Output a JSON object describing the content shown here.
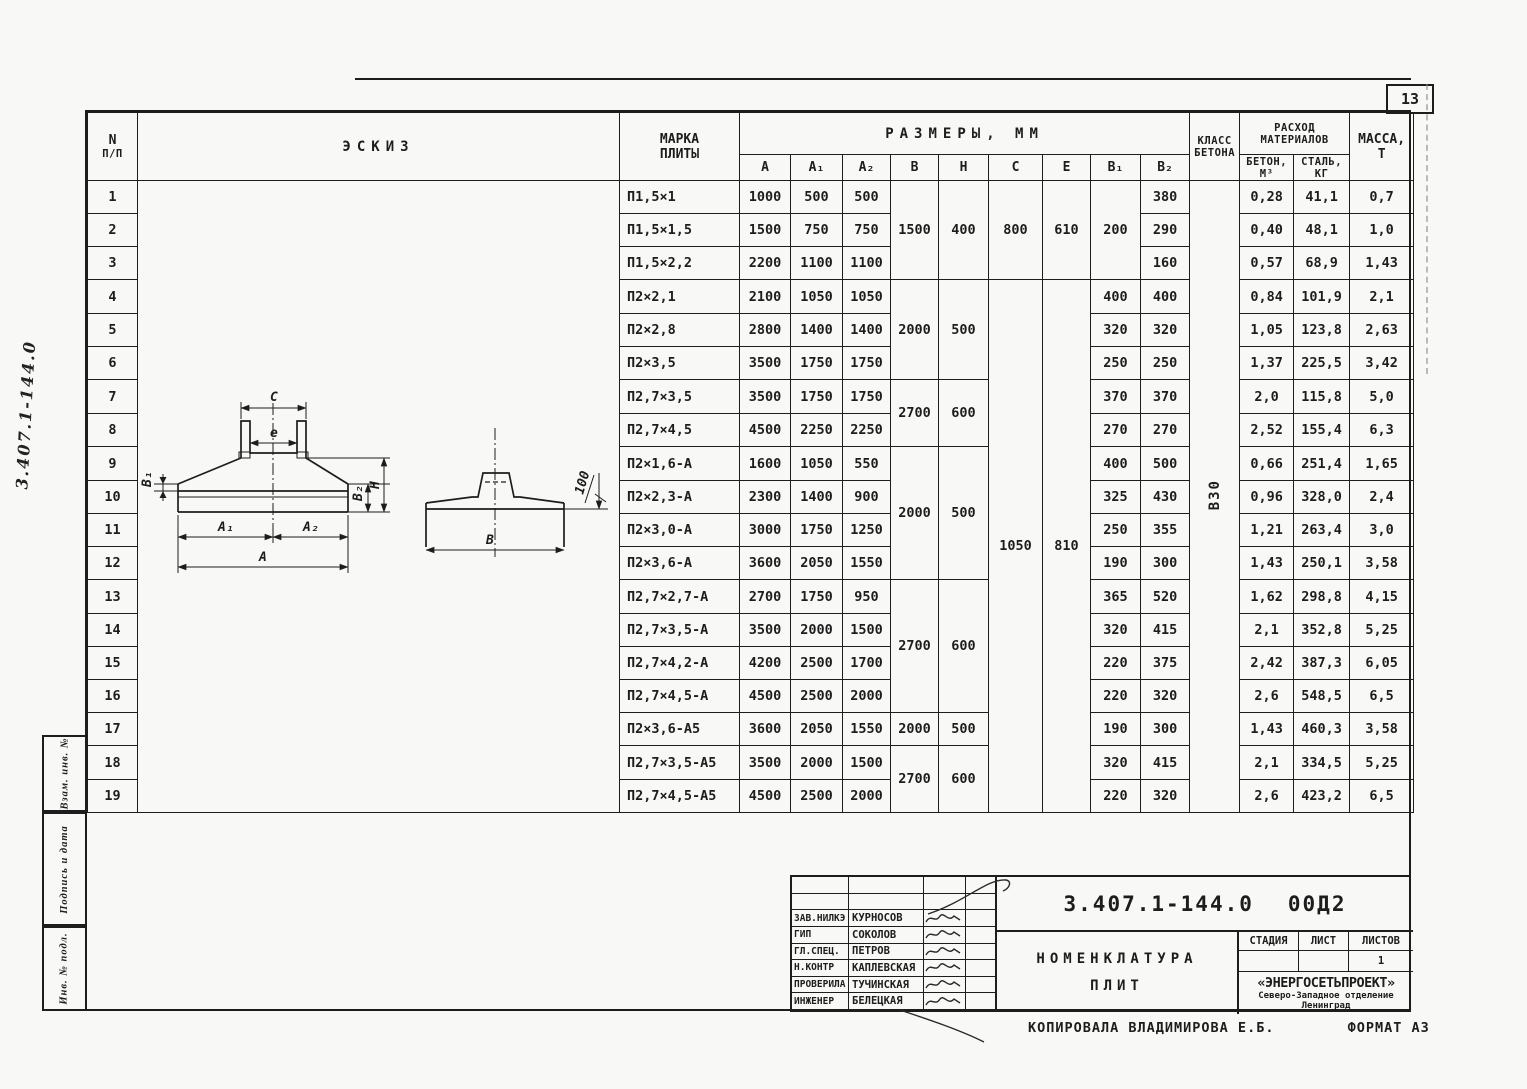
{
  "page": {
    "sheet_number": "13",
    "side_doc_number": "3.407.1-144.0",
    "bottom_note": "Копировала Владимирова Е.Б.",
    "bottom_format": "Формат А3"
  },
  "side_strip": {
    "cell1": "Взам. инв. №",
    "cell2": "Подпись и дата",
    "cell3": "Инв. № подл."
  },
  "table": {
    "header": {
      "num_l1": "N",
      "num_l2": "п/п",
      "sketch": "Эскиз",
      "mark_l1": "Марка",
      "mark_l2": "плиты",
      "sizes": "Размеры, мм",
      "size_cols": [
        "А",
        "А₁",
        "А₂",
        "В",
        "Н",
        "С",
        "е",
        "В₁",
        "В₂"
      ],
      "class_l1": "Класс",
      "class_l2": "бетона",
      "materials_l1": "Расход",
      "materials_l2": "материалов",
      "concrete_l1": "Бетон,",
      "concrete_l2": "м³",
      "steel_l1": "Сталь,",
      "steel_l2": "кг",
      "mass_l1": "Масса,",
      "mass_l2": "т"
    },
    "concrete_class": "В30",
    "rows": [
      {
        "n": "1",
        "mark": "П1,5×1",
        "a": "1000",
        "a1": "500",
        "a2": "500",
        "b2": "380",
        "concrete": "0,28",
        "steel": "41,1",
        "mass": "0,7"
      },
      {
        "n": "2",
        "mark": "П1,5×1,5",
        "a": "1500",
        "a1": "750",
        "a2": "750",
        "b2": "290",
        "concrete": "0,40",
        "steel": "48,1",
        "mass": "1,0"
      },
      {
        "n": "3",
        "mark": "П1,5×2,2",
        "a": "2200",
        "a1": "1100",
        "a2": "1100",
        "b2": "160",
        "concrete": "0,57",
        "steel": "68,9",
        "mass": "1,43"
      },
      {
        "n": "4",
        "mark": "П2×2,1",
        "a": "2100",
        "a1": "1050",
        "a2": "1050",
        "b2": "400",
        "concrete": "0,84",
        "steel": "101,9",
        "mass": "2,1"
      },
      {
        "n": "5",
        "mark": "П2×2,8",
        "a": "2800",
        "a1": "1400",
        "a2": "1400",
        "b2": "320",
        "concrete": "1,05",
        "steel": "123,8",
        "mass": "2,63"
      },
      {
        "n": "6",
        "mark": "П2×3,5",
        "a": "3500",
        "a1": "1750",
        "a2": "1750",
        "b2": "250",
        "concrete": "1,37",
        "steel": "225,5",
        "mass": "3,42"
      },
      {
        "n": "7",
        "mark": "П2,7×3,5",
        "a": "3500",
        "a1": "1750",
        "a2": "1750",
        "b2": "370",
        "concrete": "2,0",
        "steel": "115,8",
        "mass": "5,0"
      },
      {
        "n": "8",
        "mark": "П2,7×4,5",
        "a": "4500",
        "a1": "2250",
        "a2": "2250",
        "b2": "270",
        "concrete": "2,52",
        "steel": "155,4",
        "mass": "6,3"
      },
      {
        "n": "9",
        "mark": "П2×1,6-А",
        "a": "1600",
        "a1": "1050",
        "a2": "550",
        "b2": "500",
        "concrete": "0,66",
        "steel": "251,4",
        "mass": "1,65"
      },
      {
        "n": "10",
        "mark": "П2×2,3-А",
        "a": "2300",
        "a1": "1400",
        "a2": "900",
        "b2": "430",
        "concrete": "0,96",
        "steel": "328,0",
        "mass": "2,4"
      },
      {
        "n": "11",
        "mark": "П2×3,0-А",
        "a": "3000",
        "a1": "1750",
        "a2": "1250",
        "b2": "355",
        "concrete": "1,21",
        "steel": "263,4",
        "mass": "3,0"
      },
      {
        "n": "12",
        "mark": "П2×3,6-А",
        "a": "3600",
        "a1": "2050",
        "a2": "1550",
        "b2": "300",
        "concrete": "1,43",
        "steel": "250,1",
        "mass": "3,58"
      },
      {
        "n": "13",
        "mark": "П2,7×2,7-А",
        "a": "2700",
        "a1": "1750",
        "a2": "950",
        "b2": "520",
        "concrete": "1,62",
        "steel": "298,8",
        "mass": "4,15"
      },
      {
        "n": "14",
        "mark": "П2,7×3,5-А",
        "a": "3500",
        "a1": "2000",
        "a2": "1500",
        "b2": "415",
        "concrete": "2,1",
        "steel": "352,8",
        "mass": "5,25"
      },
      {
        "n": "15",
        "mark": "П2,7×4,2-А",
        "a": "4200",
        "a1": "2500",
        "a2": "1700",
        "b2": "375",
        "concrete": "2,42",
        "steel": "387,3",
        "mass": "6,05"
      },
      {
        "n": "16",
        "mark": "П2,7×4,5-А",
        "a": "4500",
        "a1": "2500",
        "a2": "2000",
        "b2": "320",
        "concrete": "2,6",
        "steel": "548,5",
        "mass": "6,5"
      },
      {
        "n": "17",
        "mark": "П2×3,6-А5",
        "a": "3600",
        "a1": "2050",
        "a2": "1550",
        "b2": "300",
        "concrete": "1,43",
        "steel": "460,3",
        "mass": "3,58"
      },
      {
        "n": "18",
        "mark": "П2,7×3,5-А5",
        "a": "3500",
        "a1": "2000",
        "a2": "1500",
        "b2": "415",
        "concrete": "2,1",
        "steel": "334,5",
        "mass": "5,25"
      },
      {
        "n": "19",
        "mark": "П2,7×4,5-А5",
        "a": "4500",
        "a1": "2500",
        "a2": "2000",
        "b2": "320",
        "concrete": "2,6",
        "steel": "423,2",
        "mass": "6,5"
      }
    ],
    "merges": {
      "b": [
        {
          "row": 1,
          "span": 3,
          "v": "1500"
        },
        {
          "row": 4,
          "span": 3,
          "v": "2000"
        },
        {
          "row": 7,
          "span": 2,
          "v": "2700"
        },
        {
          "row": 9,
          "span": 4,
          "v": "2000"
        },
        {
          "row": 13,
          "span": 4,
          "v": "2700"
        },
        {
          "row": 17,
          "span": 1,
          "v": "2000"
        },
        {
          "row": 18,
          "span": 2,
          "v": "2700"
        }
      ],
      "h": [
        {
          "row": 1,
          "span": 3,
          "v": "400"
        },
        {
          "row": 4,
          "span": 3,
          "v": "500"
        },
        {
          "row": 7,
          "span": 2,
          "v": "600"
        },
        {
          "row": 9,
          "span": 4,
          "v": "500"
        },
        {
          "row": 13,
          "span": 4,
          "v": "600"
        },
        {
          "row": 17,
          "span": 1,
          "v": "500"
        },
        {
          "row": 18,
          "span": 2,
          "v": "600"
        }
      ],
      "c": [
        {
          "row": 1,
          "span": 3,
          "v": "800"
        },
        {
          "row": 4,
          "span": 16,
          "v": "1050"
        }
      ],
      "e": [
        {
          "row": 1,
          "span": 3,
          "v": "610"
        },
        {
          "row": 4,
          "span": 16,
          "v": "810"
        }
      ],
      "b1": [
        {
          "row": 1,
          "span": 3,
          "v": "200"
        },
        {
          "row": 4,
          "span": 1,
          "v": "400"
        },
        {
          "row": 5,
          "span": 1,
          "v": "320"
        },
        {
          "row": 6,
          "span": 1,
          "v": "250"
        },
        {
          "row": 7,
          "span": 1,
          "v": "370"
        },
        {
          "row": 8,
          "span": 1,
          "v": "270"
        },
        {
          "row": 9,
          "span": 1,
          "v": "400"
        },
        {
          "row": 10,
          "span": 1,
          "v": "325"
        },
        {
          "row": 11,
          "span": 1,
          "v": "250"
        },
        {
          "row": 12,
          "span": 1,
          "v": "190"
        },
        {
          "row": 13,
          "span": 1,
          "v": "365"
        },
        {
          "row": 14,
          "span": 1,
          "v": "320"
        },
        {
          "row": 15,
          "span": 1,
          "v": "220"
        },
        {
          "row": 16,
          "span": 1,
          "v": "220"
        },
        {
          "row": 17,
          "span": 1,
          "v": "190"
        },
        {
          "row": 18,
          "span": 1,
          "v": "320"
        },
        {
          "row": 19,
          "span": 1,
          "v": "220"
        }
      ],
      "klass": [
        {
          "row": 1,
          "span": 19,
          "v": "В30"
        }
      ]
    }
  },
  "sketch": {
    "labels": {
      "c": "С",
      "e": "е",
      "b1": "В₁",
      "b2": "В₂",
      "h": "Н",
      "a1": "А₁",
      "a2": "А₂",
      "a": "А",
      "b": "В",
      "d100": "100"
    }
  },
  "stamp": {
    "doc_number": "3.407.1-144.0",
    "doc_suffix": "00Д2",
    "title_l1": "Номенклатура",
    "title_l2": "плит",
    "stage_label": "Стадия",
    "sheet_label": "Лист",
    "sheets_label": "Листов",
    "stage_value": "",
    "sheet_value": "",
    "sheets_value": "1",
    "org_name": "«ЭНЕРГОСЕТЬПРОЕКТ»",
    "org_line2": "Северо-Западное отделение",
    "org_line3": "Ленинград",
    "signatories": [
      {
        "role": "Зав.НИЛКЭ",
        "name": "Курносов"
      },
      {
        "role": "ГИП",
        "name": "Соколов"
      },
      {
        "role": "Гл.спец.",
        "name": "Петров"
      },
      {
        "role": "Н.контр",
        "name": "Каплевская"
      },
      {
        "role": "Проверила",
        "name": "Тучинская"
      },
      {
        "role": "Инженер",
        "name": "Белецкая"
      }
    ]
  }
}
